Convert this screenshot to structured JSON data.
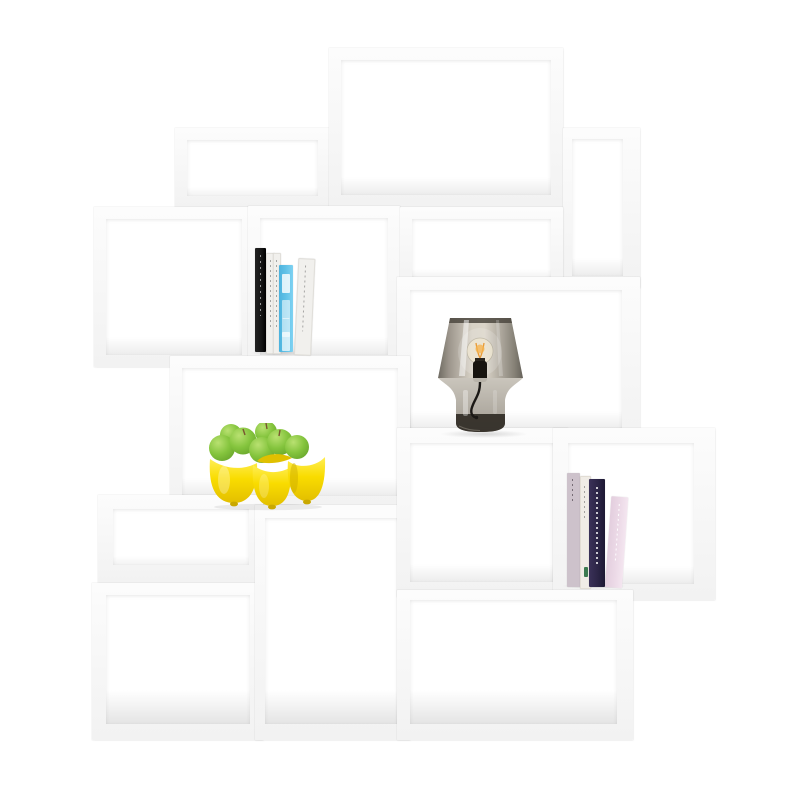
{
  "page": {
    "title": "Product photo: white stacked modular shelving unit on white background",
    "background": "#ffffff"
  },
  "colors": {
    "frame-hi": "#fcfcfc",
    "frame-lo": "#f2f2f2",
    "cavity": "#ffffff",
    "book-black": "#161616",
    "book-white": "#f1f0ed",
    "book-blue": "#5fc0e6",
    "book-mauve": "#cdc2cb",
    "book-cream": "#f0ece6",
    "book-navy": "#2c2546",
    "book-pink": "#ecdae7",
    "figure-green": "#3c7a50",
    "bowl-yellow": "#f9dc00",
    "bowl-yellow-hi": "#ffee55",
    "bowl-yellow-lo": "#c9a800",
    "apple-green": "#84c43d",
    "apple-green-hi": "#b9e171",
    "apple-green-lo": "#619e27",
    "apple-stem": "#7a5531",
    "glass-edge": "#6a665d",
    "glass-mid": "#d6d0c4",
    "glass-base-hi": "#c6c1b7",
    "glass-base-lo": "#9a948a",
    "lamp-dark": "#2d2922",
    "lamp-socket": "#17140f",
    "filament": "#e89a35"
  },
  "shelving": {
    "description": "Asymmetric stack of 14 open white rectangular shelf modules",
    "modules": [
      "top-large",
      "upper-left",
      "narrow-right",
      "left-square",
      "books-box",
      "mid-right",
      "lamp-box",
      "wide-left-mid",
      "small-shelf",
      "bottom-left",
      "bottom-mid",
      "books-row-mid",
      "books-row-right",
      "bottom-right"
    ]
  },
  "items": {
    "left_books": {
      "count": 5,
      "spines": [
        "black",
        "white",
        "white",
        "light-blue",
        "white-leaning"
      ]
    },
    "table_lamp": {
      "type": "smoked-glass table lamp",
      "bulb": "exposed glowing filament bulb",
      "cord": "black"
    },
    "fruit_bowl": {
      "color": "yellow",
      "lobes": 4,
      "fruit": "green apples",
      "fruit_count": 7
    },
    "right_books": {
      "count": 4,
      "spines": [
        "mauve",
        "cream",
        "dark-purple",
        "pink-leaning"
      ]
    }
  }
}
